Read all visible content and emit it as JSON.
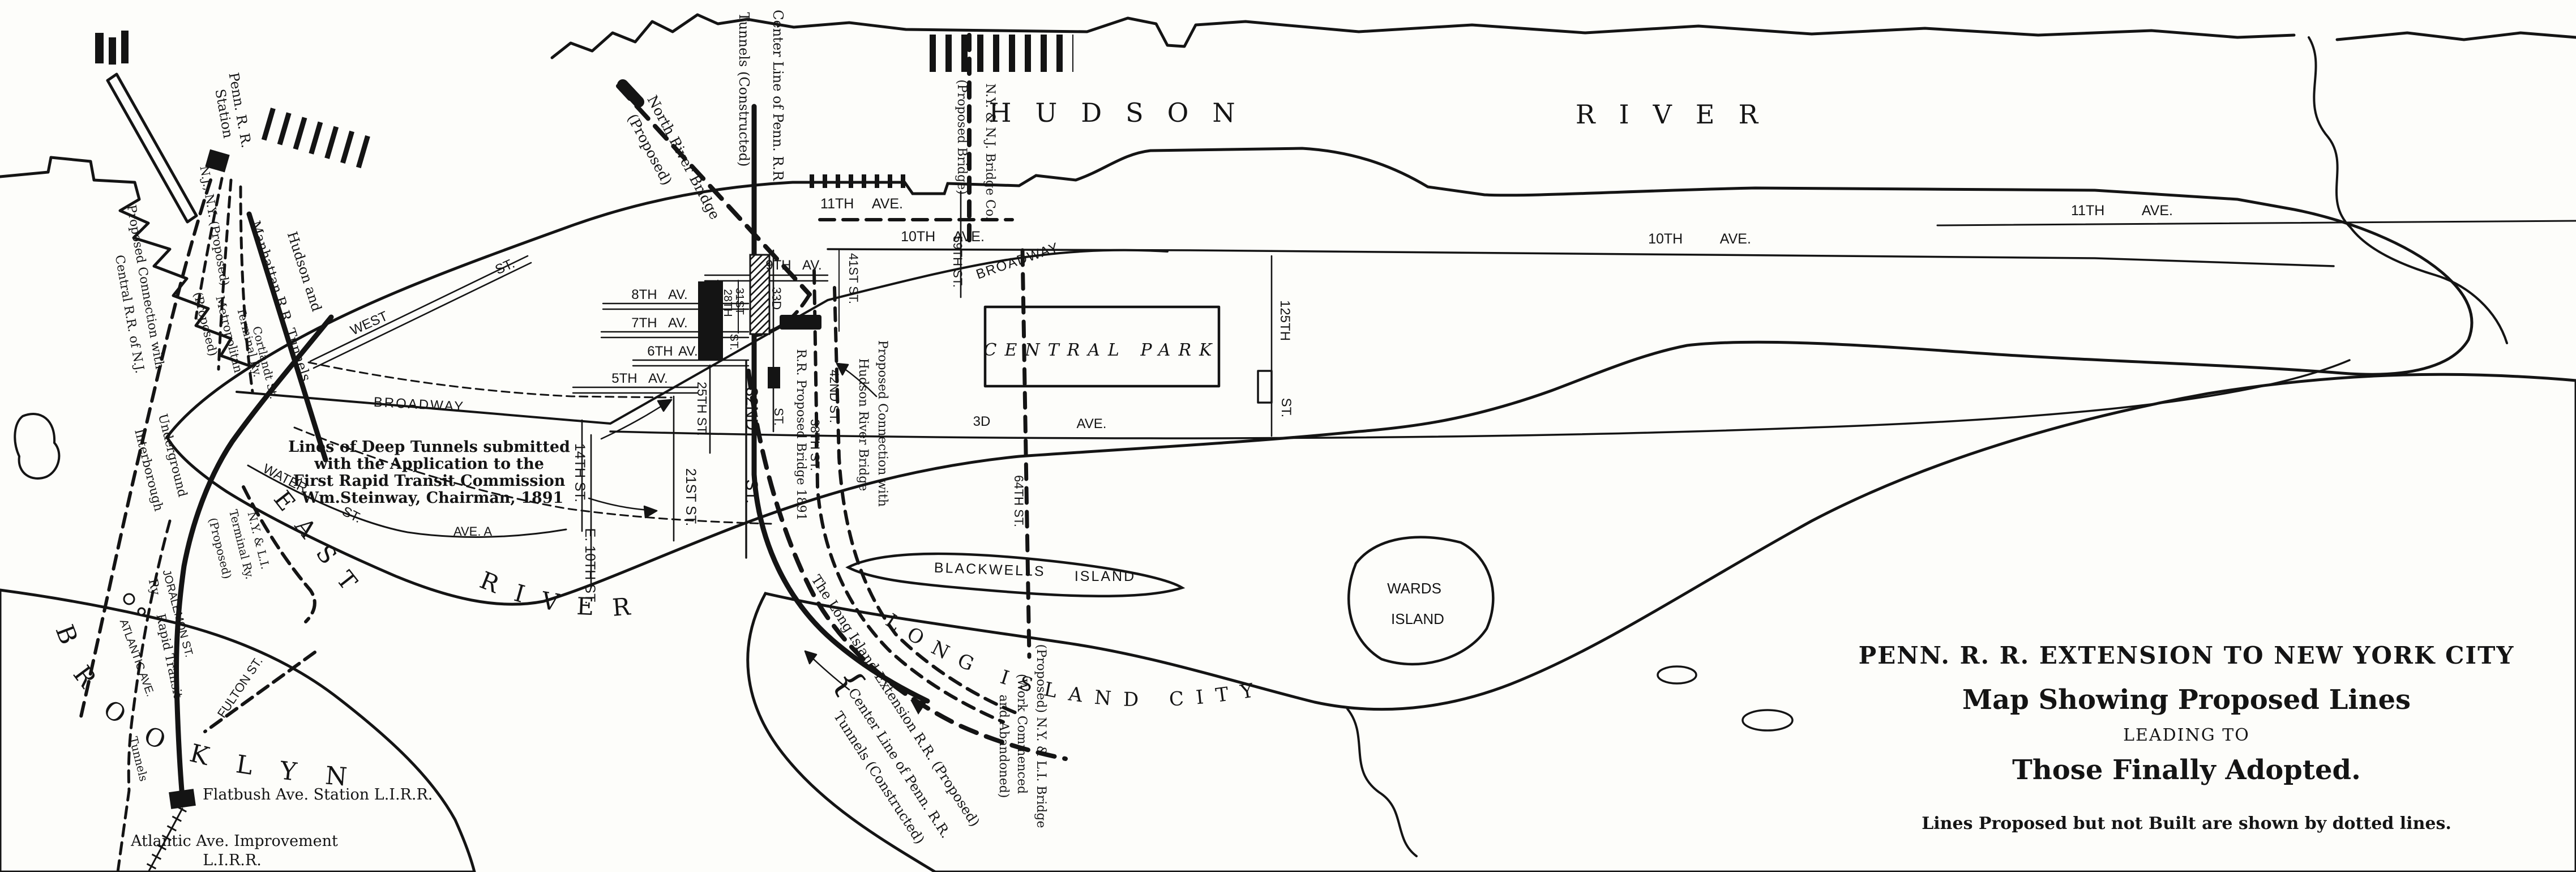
{
  "titles": {
    "l1": "PENN. R. R. EXTENSION TO NEW YORK CITY",
    "l2": "Map Showing Proposed Lines",
    "l3": "LEADING TO",
    "l4": "Those Finally Adopted.",
    "note": "Lines Proposed but not Built are shown by dotted lines."
  },
  "steinway": {
    "l1": "Lines of Deep Tunnels submitted",
    "l2": "with the Application to the",
    "l3": "First Rapid Transit Commission",
    "l4": "Wm.Steinway, Chairman, 1891"
  },
  "water": {
    "hudson1": "HUDSON",
    "hudson2": "RIVER",
    "east": "EAST",
    "river": "RIVER",
    "central_park": "CENTRAL PARK",
    "brooklyn": "BROOKLYN",
    "lic": "LONG ISLAND CITY",
    "blackwells1": "BLACKWELLS",
    "blackwells2": "ISLAND",
    "wards1": "WARDS",
    "wards2": "ISLAND"
  },
  "aves": {
    "a11l": "11TH AVE.",
    "a10l": "10TH AVE.",
    "a9": "9TH AV.",
    "a8": "8TH AV.",
    "a7": "7TH AV.",
    "a6": "6TH AV.",
    "a5": "5TH AV.",
    "a3": "3D",
    "a3b": "AVE.",
    "a10r": "10TH AVE.",
    "a11r": "11TH AVE.",
    "avea": "AVE. A",
    "bway1": "BROADWAY",
    "bway2": "BROADWAY",
    "west": "WEST",
    "westst": "ST.",
    "water": "WATER",
    "waterst": "ST."
  },
  "sts": {
    "s14": "14TH ST.",
    "e10": "E. 10TH ST.",
    "s21": "21ST ST.",
    "s25": "25TH ST.",
    "s32": "32ND",
    "s32b": "ST.",
    "s31": "31ST",
    "s28": "28TH",
    "s28b": "ST.",
    "s33": "33D",
    "s33b": "ST.",
    "s41": "41ST ST.",
    "s42": "42ND ST.",
    "s38": "38TH ST.",
    "s59": "59TH ST.",
    "s64": "64TH ST.",
    "s125": "125TH",
    "s125b": "ST.",
    "jor": "JORALEMON ST.",
    "ful": "FULTON ST."
  },
  "rr": {
    "penn1": "Penn. R. R.",
    "penn2": "Station",
    "njny": "N.J., N.Y. (Proposed)",
    "hm1": "Hudson and",
    "hm2": "Manhattan R.R. Tunnels",
    "met1": "Metropolitan",
    "met2": "(Proposed)",
    "term": "Terminal Ry.",
    "cort": "Cortlandt St.",
    "pc1": "Proposed Connection with",
    "pc2": "Central R.R. of N.J.",
    "int": "Interborough",
    "und": "Underground",
    "ry": "Ry.",
    "rapid": "Rapid Transit",
    "nylt1": "N.Y. & L.I.",
    "nylt2": "Terminal Ry.",
    "nylt3": "(Proposed)",
    "tun": "Tunnels",
    "atl": "ATLANTIC AVE.",
    "flat": "Flatbush Ave. Station L.I.R.R.",
    "ai1": "Atlantic Ave. Improvement",
    "ai2": "L.I.R.R.",
    "nrb1": "North River Bridge",
    "nrb2": "(Proposed)",
    "clp1": "Center Line of Penn. R.R.",
    "clp2": "Tunnels (Constructed)",
    "nynj1": "N.Y. & N.J. Bridge Co.",
    "nynj2": "(Proposed Bridge)",
    "rrpb": "R.R. Proposed Bridge 1891",
    "pch1": "Proposed Connection with",
    "pch2": "Hudson River Bridge",
    "lie": "The Long Island Extension R.R. (Proposed)",
    "clpt1": "Center Line of Penn. R.R.",
    "clpt2": "Tunnels (Constructed)",
    "brace": "{",
    "b1": "(Proposed) N.Y. & L.I. Bridge",
    "b2": "(Work Commenced",
    "b3": "and Abandoned)"
  }
}
